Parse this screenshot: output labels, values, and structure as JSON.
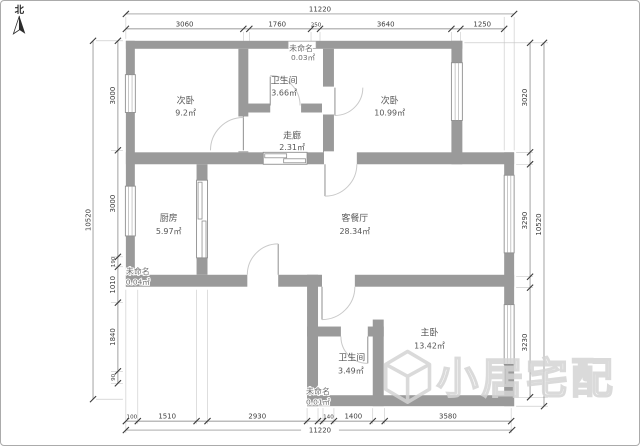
{
  "north": {
    "label": "北"
  },
  "rooms": [
    {
      "name": "次卧",
      "area": "9.2㎡"
    },
    {
      "name": "卫生间",
      "area": "3.66㎡"
    },
    {
      "name": "未命名",
      "area": "0.03㎡"
    },
    {
      "name": "次卧",
      "area": "10.99㎡"
    },
    {
      "name": "走廊",
      "area": "2.31㎡"
    },
    {
      "name": "厨房",
      "area": "5.97㎡"
    },
    {
      "name": "客餐厅",
      "area": "28.34㎡"
    },
    {
      "name": "未命名",
      "area": "0.04㎡"
    },
    {
      "name": "主卧",
      "area": "13.42㎡"
    },
    {
      "name": "卫生间",
      "area": "3.49㎡"
    },
    {
      "name": "未命名",
      "area": "0.01㎡"
    }
  ],
  "dimensions": {
    "top": {
      "total": "11220",
      "segments": [
        "3060",
        "1760",
        "250",
        "3640",
        "1250"
      ]
    },
    "bottom": {
      "total": "11220",
      "segments": [
        "100",
        "1510",
        "2930",
        "140",
        "1400",
        "3580"
      ]
    },
    "left": {
      "total": "10520",
      "segments": [
        "3000",
        "3000",
        "190",
        "1010",
        "1840",
        "90"
      ]
    },
    "right": {
      "total": "10520",
      "segments": [
        "3020",
        "3290",
        "3230"
      ]
    }
  },
  "watermark": {
    "text": "小居宅配"
  },
  "colors": {
    "wall": "#9a9a9a",
    "dim_text": "#3c3c3c",
    "room_text": "#565656",
    "watermark": "#d4d4d4"
  }
}
